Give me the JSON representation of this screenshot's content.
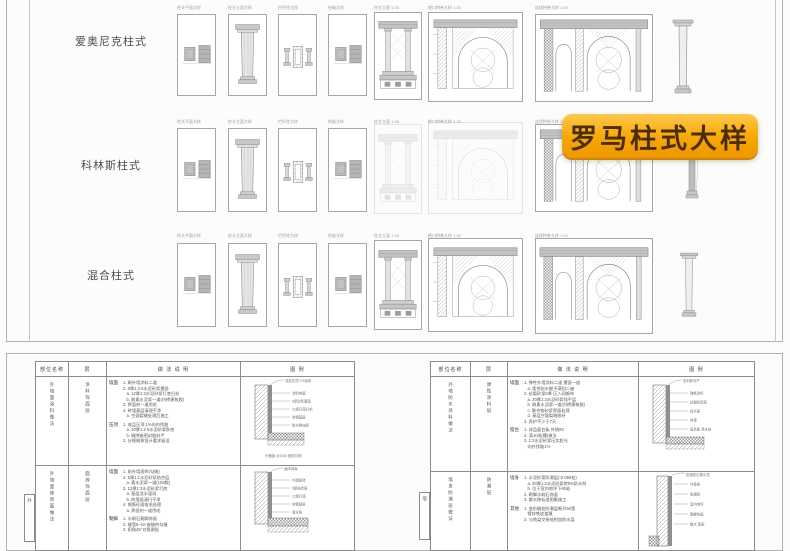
{
  "badge": {
    "label": "罗马柱式大样"
  },
  "colors": {
    "badge_top": "#ffc84a",
    "badge_bottom": "#ef9600",
    "badge_text": "#4b2d00",
    "line_art": "#8a8a8a",
    "sheet_border": "#b2b2b2"
  },
  "top_sheet": {
    "rows": [
      {
        "label": "爱奥尼克柱式",
        "captions": [
          "柱头平面大样",
          "柱头立面大样",
          "栏杆柱大样",
          "柱础大样",
          "柱式立面 1:25",
          "檐口拱券大样 1:20",
          "连续拱券大样 1:20"
        ]
      },
      {
        "label": "科林斯柱式",
        "captions": [
          "柱头平面大样",
          "柱头立面大样",
          "栏杆柱大样",
          "柱础大样",
          "柱式立面 1:25",
          "檐口拱券大样 1:20",
          "连续拱券大样 1:20"
        ]
      },
      {
        "label": "混合柱式",
        "captions": [
          "柱头平面大样",
          "柱头立面大样",
          "栏杆柱大样",
          "柱础大样",
          "柱式立面 1:25",
          "檐口拱券大样 1:20",
          "连续拱券大样 1:20"
        ]
      }
    ]
  },
  "tables": {
    "left": {
      "headers": [
        "部位名称",
        "层",
        "做 法 说 明",
        "图 例"
      ],
      "groups": [
        {
          "side": "外墙面涂料做法",
          "layer": "涂料饰面层",
          "blocks": [
            {
              "sub": "墙面",
              "lines": [
                "1. 刷外墙涂料二道",
                "2. 6厚1:2.5水泥砂浆罩面",
                "   a. 12厚1:3水泥砂浆打底扫毛",
                "   b. 刷素水泥浆一道(内掺建筑胶)",
                "3. 界面剂一道甩毛",
                "4. 砖墙基层清理干净",
                "   a. 空鼓裂缝处理后施工"
              ]
            },
            {
              "sub": "压顶",
              "lines": [
                "1. 成品压顶 1%向内找坡",
                "   a. 20厚1:2.5水泥砂浆卧底",
                "   b. 缝隙嵌密封胶封严",
                "2. 分格缝按设计要求留设"
              ]
            }
          ],
          "detail": {
            "top_note": "成品压顶 1%找坡",
            "labels": [
              "涂料饰面",
              "6厚砂浆罩面",
              "12厚打底扫毛",
              "砖墙基层",
              "防水附加层"
            ],
            "bottom_note": "分格缝 @1500 嵌密封胶"
          }
        },
        {
          "side": "外墙面砖饰面做法",
          "layer": "面砖饰面层",
          "tab": "外",
          "blocks": [
            {
              "sub": "墙面",
              "lines": [
                "1. 贴外墙面砖(勾缝)",
                "2. 5厚1:1水泥砂浆结合层",
                "   a. 素水泥浆一道(108胶)",
                "3. 12厚1:3水泥砂浆打底",
                "   a. 基层浇水湿润",
                "   b. 砖墙面清扫干净",
                "4. 钢筋砼面凿毛处理",
                "   a. 界面剂一道甩毛"
              ]
            },
            {
              "sub": "勒脚",
              "lines": [
                "1. 水刷石勒脚饰面",
                "2. 缝宽8~10 嵌缝剂勾缝",
                "3. 阳角45°对角割贴"
              ]
            }
          ],
          "detail": {
            "top_note": "面砖饰面",
            "labels": [
              "外墙面砖",
              "5厚结合层",
              "12厚打底",
              "砖墙基层",
              "滴水线"
            ],
            "bottom_note": ""
          }
        }
      ]
    },
    "right": {
      "headers": [
        "部位名称",
        "层",
        "做 法 说 明",
        "图 例"
      ],
      "groups": [
        {
          "side": "外墙防水涂料做法",
          "layer": "弹性涂料层",
          "blocks": [
            {
              "sub": "墙面",
              "lines": [
                "1. 弹性外墙涂料二道 罩面一道",
                "   a. 柔性耐水腻子满刮二遍",
                "2. 抗裂砂浆6厚 压入网格布",
                "   a. 20厚1:3水泥砂浆找平层",
                "   b. 刷素水泥浆一道(内掺建筑胶)",
                "   c. 聚合物砂浆界面处理",
                "   d. 基层空鼓裂缝修补",
                "3. 养护不少于7天"
              ]
            },
            {
              "sub": "窗台",
              "lines": [
                "1. 成品窗台板 外挑60",
                "2. 滴水线(槽)做法",
                "3. 1:2水泥砂浆压实赶光",
                "   向外找坡1%"
              ]
            }
          ],
          "detail": {
            "top_note": "密封胶封严",
            "labels": [
              "弹性涂料",
              "抗裂砂浆层",
              "找平层",
              "砖墙",
              "窗台板 滴水线"
            ],
            "bottom_note": ""
          }
        },
        {
          "side": "墙身防潮层做法",
          "layer": "防潮层",
          "tab": "墙",
          "blocks": [
            {
              "sub": "墙身",
              "lines": [
                "1. 水泥砂浆防潮层(-0.060处)",
                "   a. 20厚1:2水泥砂浆掺5%防水剂",
                "   b. 位于室内地坪下60处",
                "2. 勒脚水刷石饰面",
                "3. 散水按标准图集施工"
              ]
            },
            {
              "sub": "其他",
              "lines": [
                "1. 变形缝处防潮层断开50宽",
                "   镀锌铁皮盖缝",
                "2. 与地梁交接处附加防水层"
              ]
            }
          ],
          "detail": {
            "top_note": "防潮层位置示意",
            "labels": [
              "外墙身",
              "防潮层",
              "室内地坪",
              "勒脚饰面",
              "散水 垫层"
            ],
            "bottom_note": ""
          }
        }
      ]
    }
  }
}
